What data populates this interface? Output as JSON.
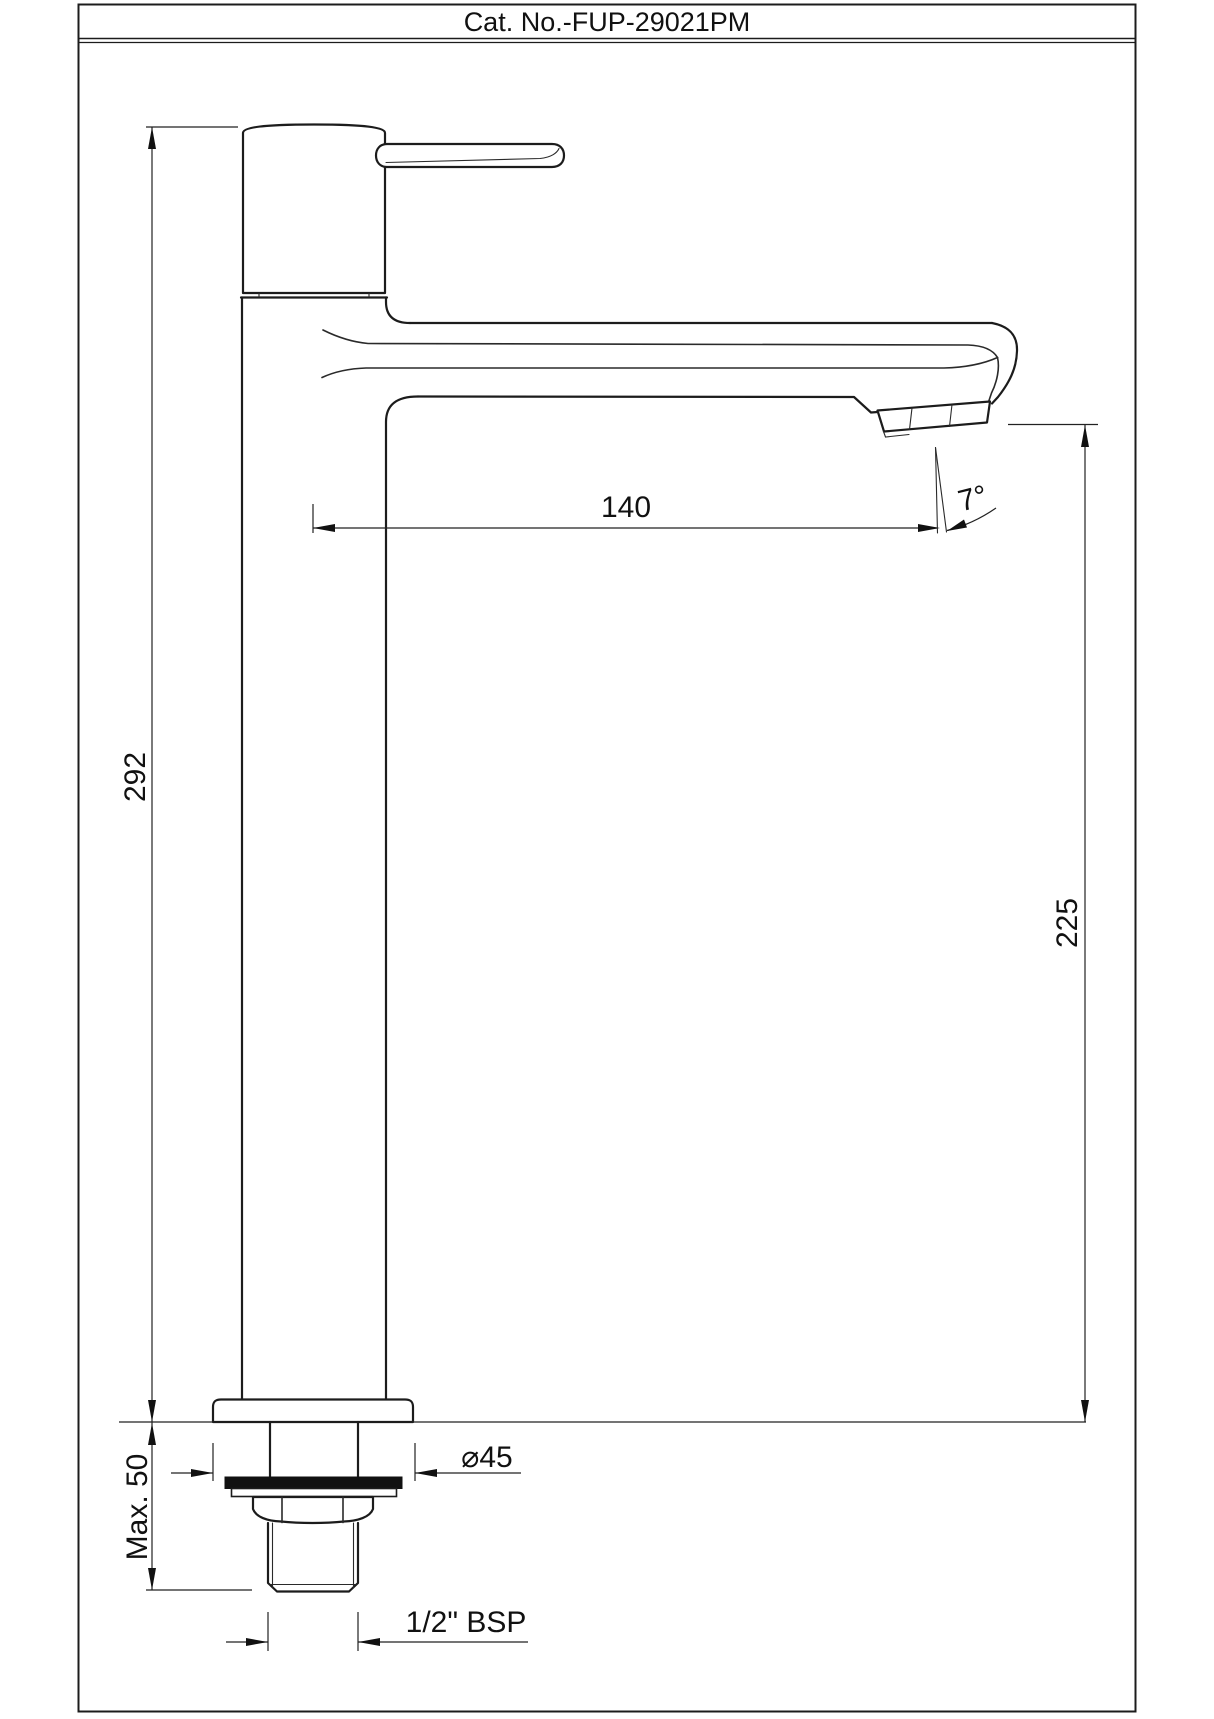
{
  "title_bar": {
    "catalog_number": "Cat. No.-FUP-29021PM"
  },
  "dimensions": {
    "overall_height": "292",
    "spout_reach": "140",
    "spout_angle": "7°",
    "spout_outlet_height": "225",
    "max_deck_thickness": "Max. 50",
    "base_diameter": "⌀45",
    "inlet_thread": "1/2\" BSP"
  }
}
